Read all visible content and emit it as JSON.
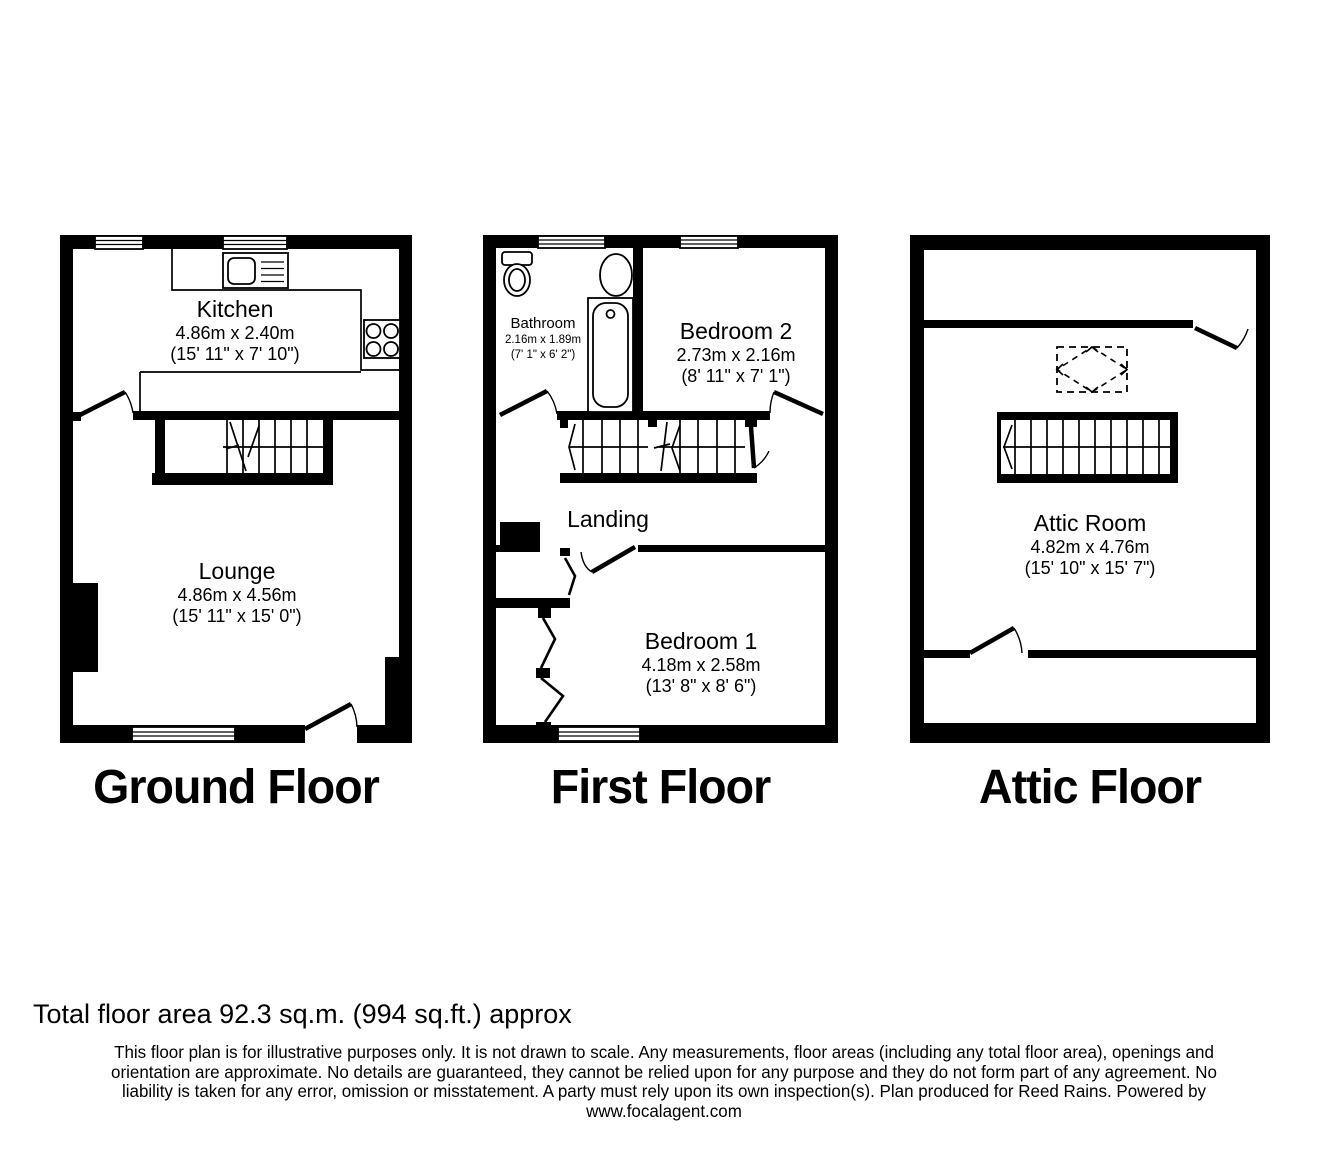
{
  "colors": {
    "wall": "#000000",
    "background": "#ffffff",
    "text": "#000000"
  },
  "floors": [
    {
      "id": "ground",
      "title": "Ground Floor",
      "rooms": [
        {
          "name": "Kitchen",
          "dims_m": "4.86m x 2.40m",
          "dims_ft": "(15' 11\" x 7' 10\")"
        },
        {
          "name": "Lounge",
          "dims_m": "4.86m x 4.56m",
          "dims_ft": "(15' 11\" x 15' 0\")"
        }
      ]
    },
    {
      "id": "first",
      "title": "First Floor",
      "rooms": [
        {
          "name": "Bathroom",
          "dims_m": "2.16m x 1.89m",
          "dims_ft": "(7' 1\" x 6' 2\")"
        },
        {
          "name": "Bedroom 2",
          "dims_m": "2.73m x 2.16m",
          "dims_ft": "(8' 11\" x 7' 1\")"
        },
        {
          "name": "Landing"
        },
        {
          "name": "Bedroom 1",
          "dims_m": "4.18m x 2.58m",
          "dims_ft": "(13' 8\" x 8' 6\")"
        }
      ]
    },
    {
      "id": "attic",
      "title": "Attic Floor",
      "rooms": [
        {
          "name": "Attic Room",
          "dims_m": "4.82m x 4.76m",
          "dims_ft": "(15' 10\" x 15' 7\")"
        }
      ]
    }
  ],
  "footer": {
    "total_area": "Total floor area 92.3 sq.m. (994 sq.ft.) approx",
    "disclaimer_lines": [
      "This floor plan is for illustrative purposes only. It is not drawn to scale. Any measurements, floor areas (including any total floor area), openings and",
      "orientation are approximate. No details are guaranteed, they cannot be relied upon for any purpose and they do not form part of any agreement. No",
      "liability is taken for any error, omission or misstatement. A party must rely upon its own inspection(s). Plan produced for Reed Rains. Powered by",
      "www.focalagent.com"
    ]
  }
}
